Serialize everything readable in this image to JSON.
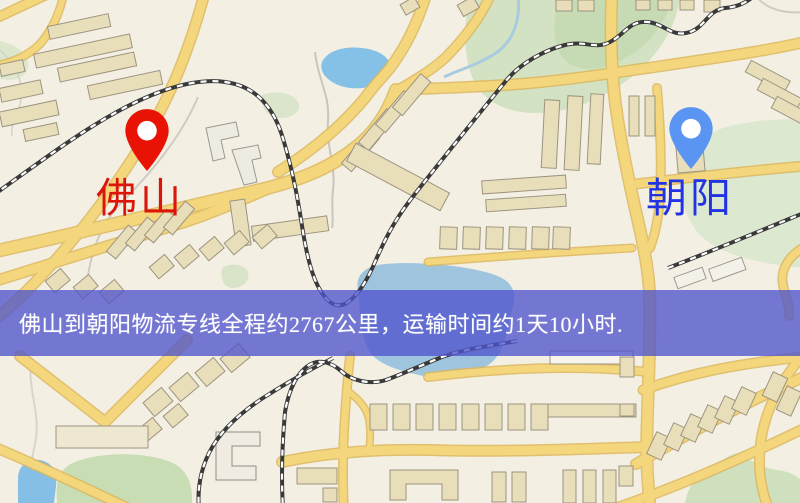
{
  "map": {
    "markers": [
      {
        "id": "origin",
        "label": "佛山",
        "pin_color": "#e81305",
        "label_color": "#dc150a"
      },
      {
        "id": "destination",
        "label": "朝阳",
        "pin_color": "#5b95f4",
        "label_color": "#2133e2"
      }
    ],
    "banner": {
      "text": "佛山到朝阳物流专线全程约2767公里，运输时间约1天10小时.",
      "background_color": "#5054cd",
      "text_color": "#ffffff"
    }
  }
}
